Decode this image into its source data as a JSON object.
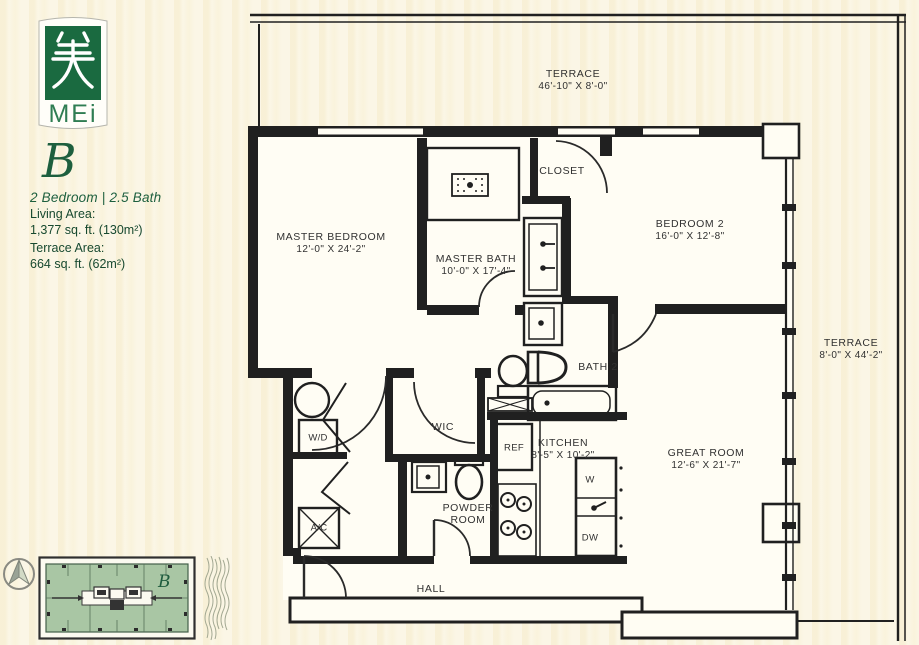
{
  "branding": {
    "logo_glyph_char": "美",
    "logo_text": "MEi",
    "unit_letter": "B",
    "unit_type": "2 Bedroom | 2.5 Bath",
    "living_area_label": "Living Area:",
    "living_area_value": "1,377 sq. ft. (130m²)",
    "terrace_area_label": "Terrace Area:",
    "terrace_area_value": "664 sq. ft. (62m²)"
  },
  "floorplan": {
    "rooms": [
      {
        "id": "terrace-top",
        "name": "TERRACE",
        "dims": "46'-10\" X 8'-0\""
      },
      {
        "id": "master-bedroom",
        "name": "MASTER BEDROOM",
        "dims": "12'-0\" X 24'-2\""
      },
      {
        "id": "master-bath",
        "name": "MASTER BATH",
        "dims": "10'-0\" X 17'-4\""
      },
      {
        "id": "closet",
        "name": "CLOSET"
      },
      {
        "id": "bedroom-2",
        "name": "BEDROOM 2",
        "dims": "16'-0\" X 12'-8\""
      },
      {
        "id": "terrace-right",
        "name": "TERRACE",
        "dims": "8'-0\" X 44'-2\""
      },
      {
        "id": "bath-2",
        "name": "BATH 2"
      },
      {
        "id": "wic",
        "name": "WIC"
      },
      {
        "id": "kitchen",
        "name": "KITCHEN",
        "dims": "8'-5\" X 10'-2\""
      },
      {
        "id": "great-room",
        "name": "GREAT ROOM",
        "dims": "12'-6\" X 21'-7\""
      },
      {
        "id": "powder-room",
        "name": "POWDER ROOM",
        "line1": "POWDER",
        "line2": "ROOM"
      },
      {
        "id": "hall",
        "name": "HALL"
      }
    ],
    "fixtures": {
      "washer_dryer": "W/D",
      "air_conditioner": "A/C",
      "refrigerator": "REF",
      "island_sink": "W",
      "dishwasher": "DW"
    }
  },
  "keyplan": {
    "unit_letter": "B"
  },
  "colors": {
    "brand_green": "#1a6a40",
    "text_green": "#1d5f3e",
    "keyplan_green": "#a9c6a4",
    "line_ink": "#202020",
    "paper": "#fbf6e6"
  }
}
